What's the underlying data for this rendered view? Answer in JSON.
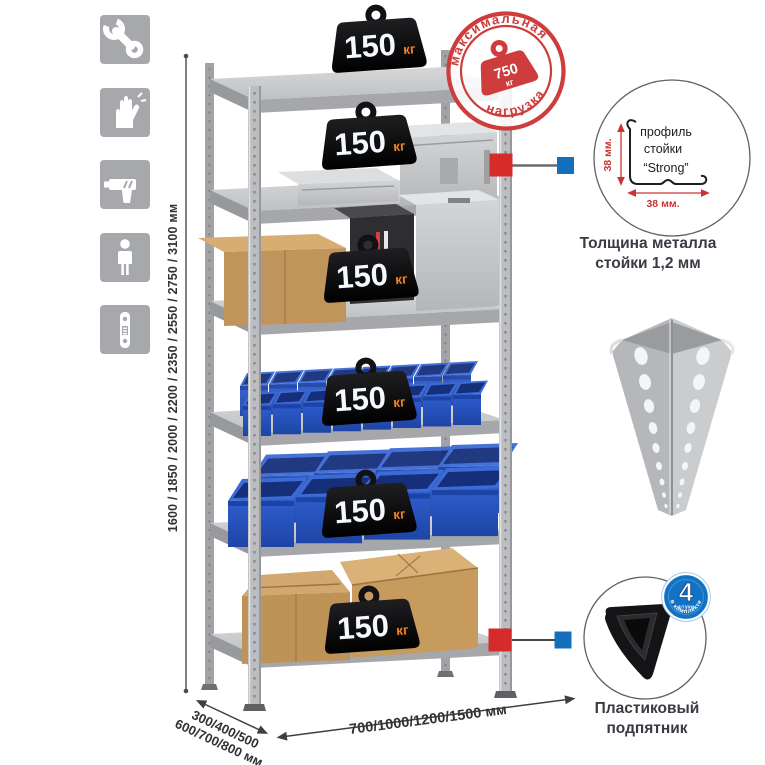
{
  "sidebar": {
    "tile_color": "#a7a8ab",
    "icons": [
      "wrench-icon",
      "gloves-icon",
      "drill-icon",
      "person-icon",
      "rack-post-icon"
    ]
  },
  "dimensions": {
    "height": "1600 / 1850 / 2000 / 2200 / 2350 / 2550 / 2750 / 3100 мм",
    "depth_line1": "300/400/500",
    "depth_line2": "600/700/800 мм",
    "width": "700/1000/1200/1500 мм"
  },
  "stamp": {
    "arc_top": "максимальная",
    "arc_bottom": "нагрузка",
    "weight_value": "750",
    "weight_unit": "кг",
    "color": "#ce3c3c"
  },
  "shelf_load": {
    "value": "150",
    "unit": "кг",
    "shelf_count": 6
  },
  "profile_detail": {
    "label_line1": "профиль",
    "label_line2": "стойки",
    "label_line3": "“Strong”",
    "dim_side": "38 мм.",
    "dim_bottom": "38 мм.",
    "caption_line1": "Толщина металла",
    "caption_line2": "стойки 1,2 мм"
  },
  "foot_detail": {
    "badge_number": "4",
    "badge_sub": "штуки",
    "badge_arc": "в комплекте",
    "caption_line1": "Пластиковый",
    "caption_line2": "подпятник"
  },
  "colors": {
    "accent_red": "#ce3c3c",
    "marker_red": "#d62b2b",
    "marker_blue": "#146fbd",
    "bin_blue": "#2352c1",
    "badge_unit_orange": "#ee8322",
    "metal_gray": "#c9cacc"
  }
}
